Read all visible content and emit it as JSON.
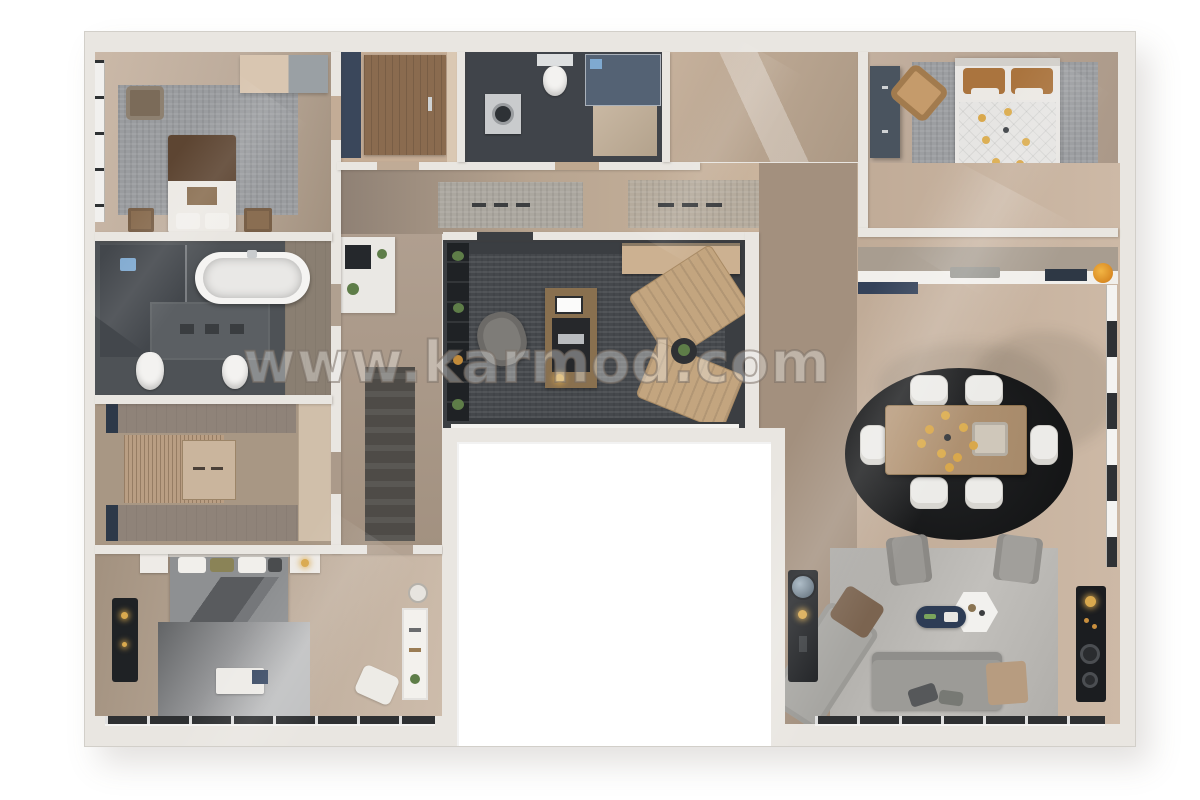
{
  "watermark": {
    "text": "www.karmod.com"
  },
  "plan": {
    "kind": "3d-floor-plan-top-view",
    "rooms": [
      {
        "id": "bedroom-top-left",
        "furniture": [
          "double-bed-brown-duvet",
          "nightstand-left",
          "nightstand-right",
          "area-rug",
          "bench",
          "wardrobe",
          "window-strip"
        ]
      },
      {
        "id": "bathroom-left",
        "furniture": [
          "freestanding-bathtub",
          "walk-in-shower",
          "shower-head",
          "tile-mat",
          "toilet",
          "bidet"
        ]
      },
      {
        "id": "walk-in-closet",
        "furniture": [
          "shelf-top",
          "shelf-bottom",
          "slatted-cabinet",
          "island-dresser",
          "wardrobe-right"
        ]
      },
      {
        "id": "bedroom-bottom-left",
        "furniture": [
          "double-bed-gray-duvet",
          "nightstand-left",
          "nightstand-right",
          "black-bench",
          "area-rug",
          "breakfast-tray",
          "bookshelf",
          "floor-pillow",
          "stool"
        ]
      },
      {
        "id": "entry-hall",
        "furniture": [
          "front-door",
          "side-panel"
        ]
      },
      {
        "id": "bathroom-top",
        "furniture": [
          "toilet",
          "washing-machine",
          "glass-shower",
          "bath-mat"
        ]
      },
      {
        "id": "hallway",
        "furniture": [
          "runner-rug-1",
          "runner-rug-2",
          "dark-runner",
          "coffee-station",
          "plants"
        ]
      },
      {
        "id": "bedroom-top-right",
        "furniture": [
          "double-bed-quilted-duvet",
          "wardrobe",
          "accent-chair",
          "ceiling-chandelier",
          "area-rug",
          "dresser"
        ]
      },
      {
        "id": "home-office",
        "furniture": [
          "desk",
          "monitor",
          "desk-mat",
          "laptop",
          "desk-lamp",
          "office-chair",
          "lounge-chair-1",
          "lounge-chair-2",
          "side-table",
          "bookshelf",
          "console"
        ]
      },
      {
        "id": "kitchen",
        "furniture": [
          "counter",
          "sink",
          "cooktop",
          "fruit-bowl",
          "island-cabinet"
        ]
      },
      {
        "id": "dining-area",
        "furniture": [
          "oval-black-rug",
          "dining-table",
          "chairs-x6",
          "chandelier",
          "window-wall"
        ]
      },
      {
        "id": "living-area",
        "furniture": [
          "sectional-sofa",
          "chaise",
          "brown-cushion",
          "tan-cushion",
          "armchair-1",
          "armchair-2",
          "hex-coffee-table",
          "navy-tray-table",
          "tv-console",
          "media-console",
          "area-rug",
          "window-band"
        ]
      }
    ],
    "palette": {
      "wall": "#e9e6e1",
      "wood_light": "#cdb9a6",
      "wood_dark": "#a3907e",
      "charcoal_floor": "#3b3e42",
      "slate_bath": "#4e5256",
      "rug_gray": "#9a9c9f",
      "dining_rug_black": "#1b1c1e",
      "sofa_gray": "#9c9b97",
      "accent_tan": "#c3a57f",
      "accent_navy": "#344259",
      "accent_gold": "#d9a84c",
      "duvet_brown": "#5d4532",
      "pillow_brown": "#aa743e"
    }
  }
}
